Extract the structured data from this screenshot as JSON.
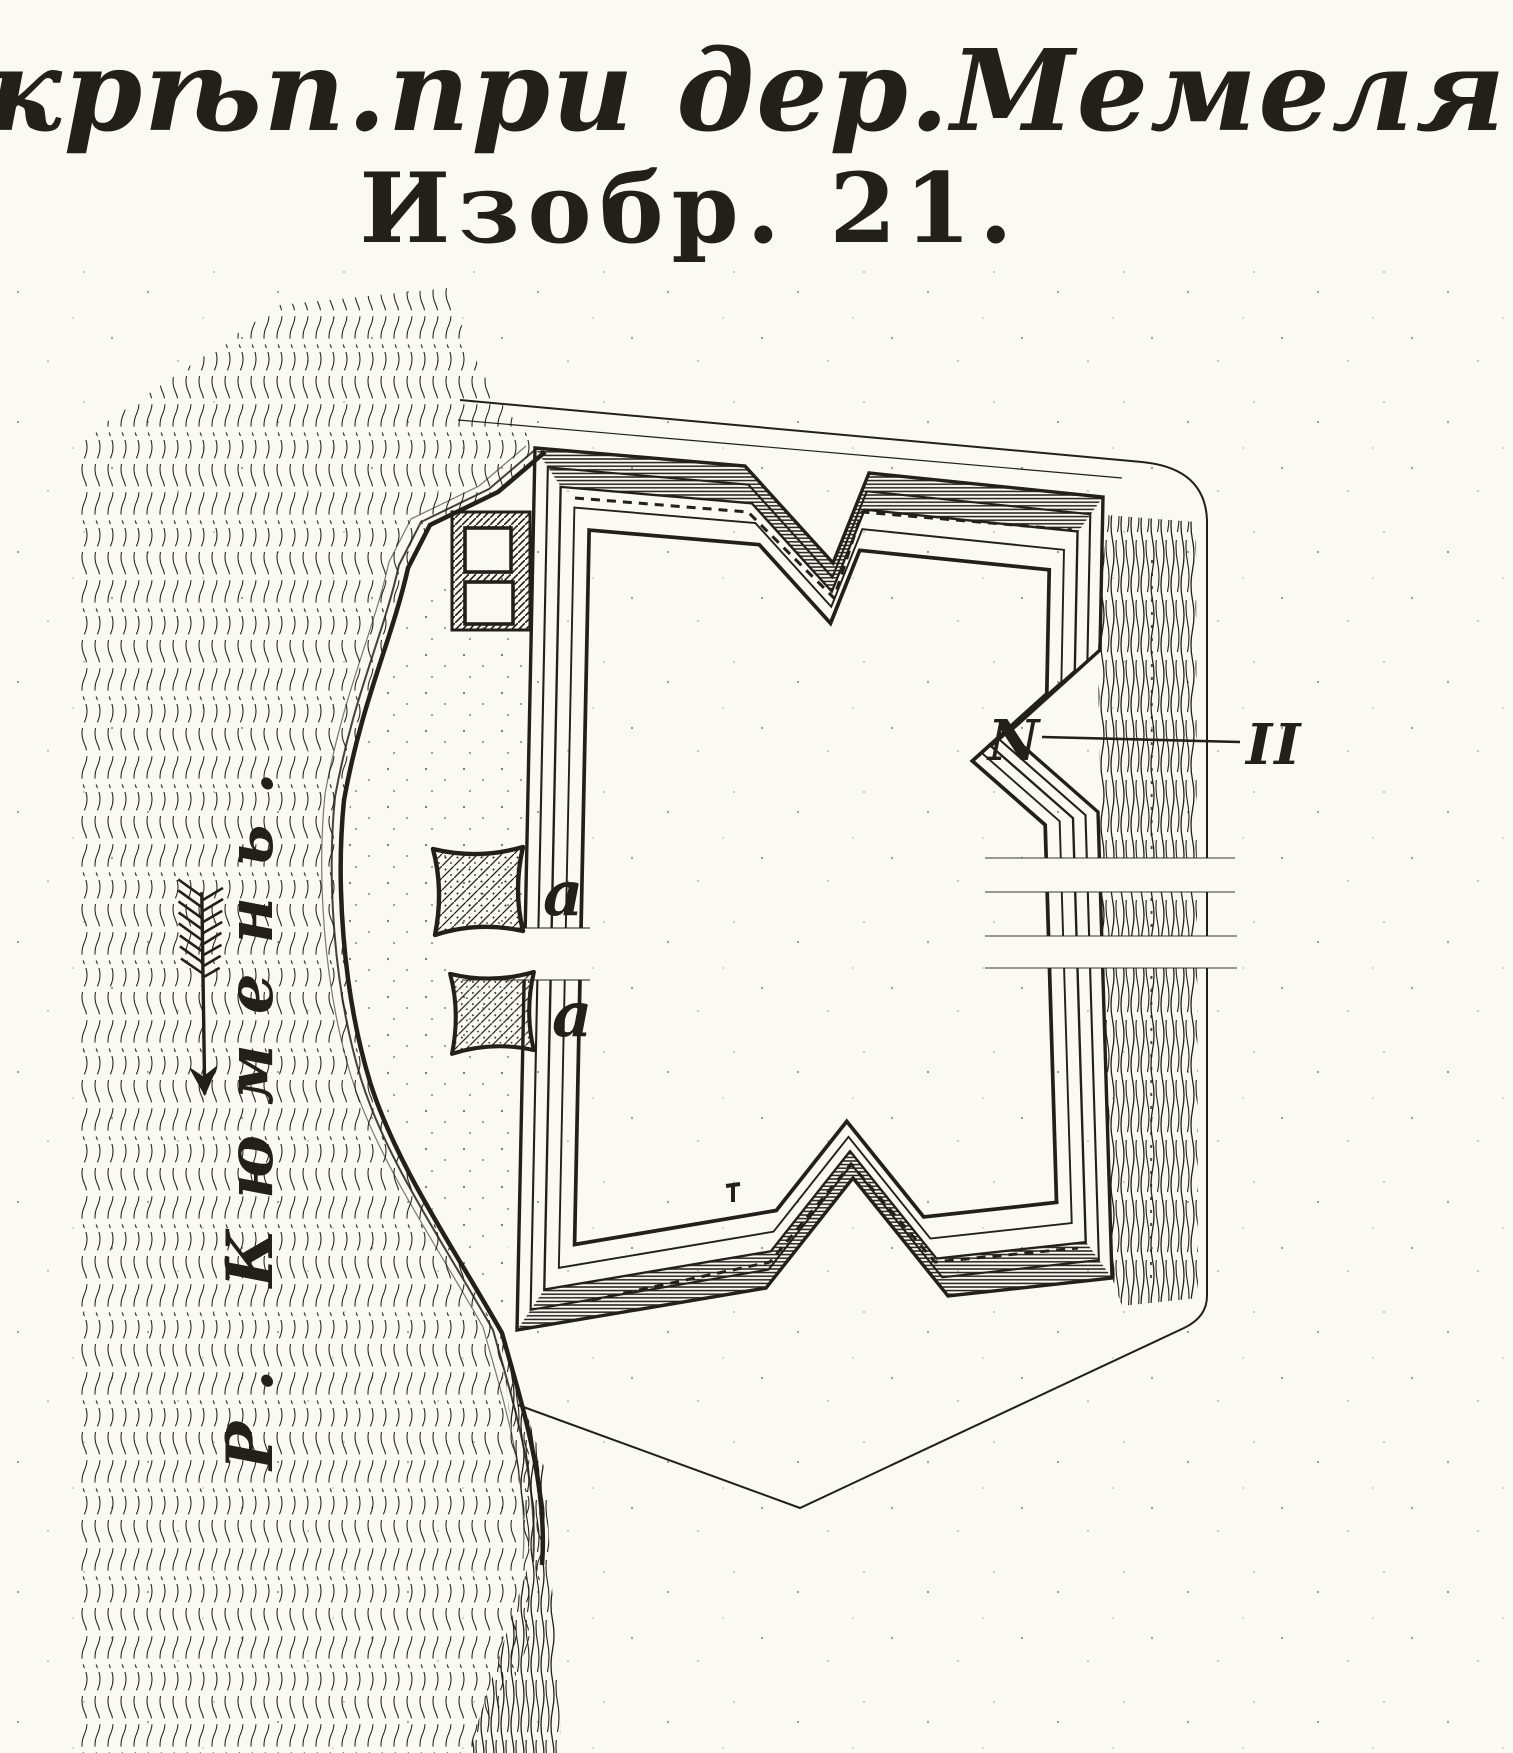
{
  "figure": {
    "title": "Укрѣп.при дер.Мемеля",
    "number_caption": "Изобр. 21."
  },
  "map": {
    "river_label": "Р. Кюмень.",
    "redoubt_labels": {
      "upper": "a",
      "lower": "a"
    },
    "section_markers": {
      "left": "N",
      "right": "II"
    },
    "icons": {
      "flow_arrow": "flow-arrow-icon"
    },
    "colors": {
      "ink": "#232019",
      "paper": "#faf9f4"
    }
  }
}
